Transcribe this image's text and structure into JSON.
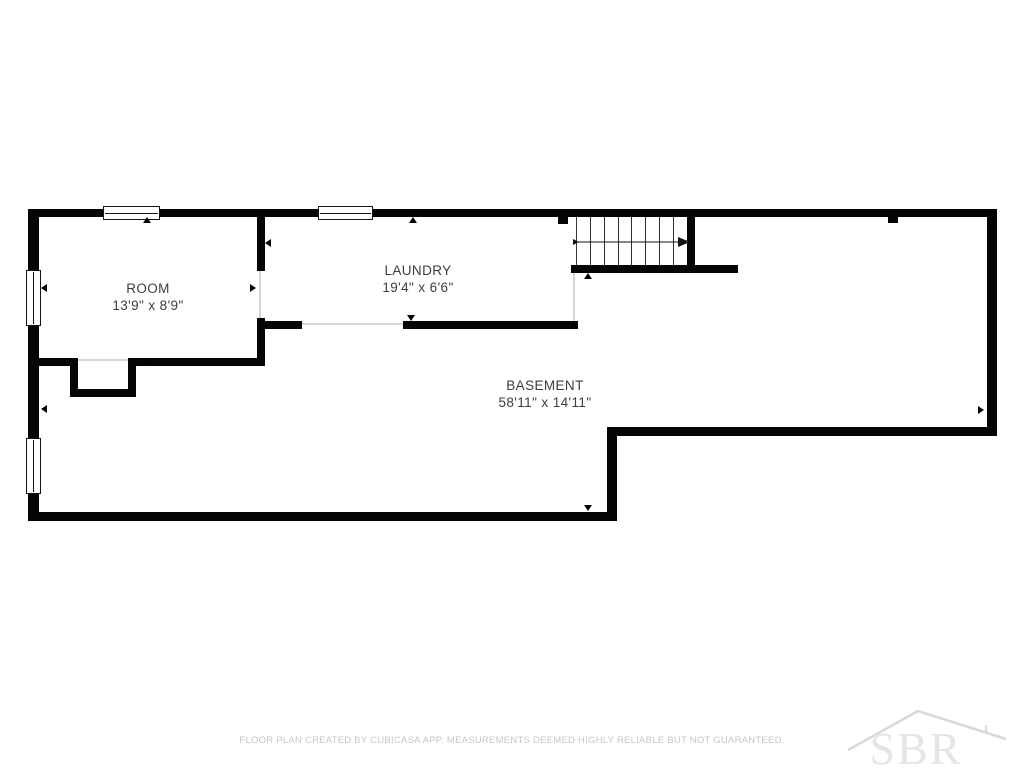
{
  "plan": {
    "rooms": [
      {
        "name": "ROOM",
        "dimensions": "13'9\" x 8'9\""
      },
      {
        "name": "LAUNDRY",
        "dimensions": "19'4\" x 6'6\""
      },
      {
        "name": "BASEMENT",
        "dimensions": "58'11\" x 14'11\""
      }
    ],
    "stairs": {
      "treads": 8,
      "direction": "right"
    }
  },
  "footer": {
    "disclaimer": "FLOOR PLAN CREATED BY CUBICASA APP. MEASUREMENTS DEEMED HIGHLY RELIABLE BUT NOT GUARANTEED."
  },
  "watermark": {
    "text": "SBR"
  },
  "colors": {
    "wall": "#050505",
    "label": "#3d3d3d",
    "footer": "#c7c7c7",
    "watermark": "#e5e5e5",
    "watermark-line": "#d9d9d9"
  }
}
